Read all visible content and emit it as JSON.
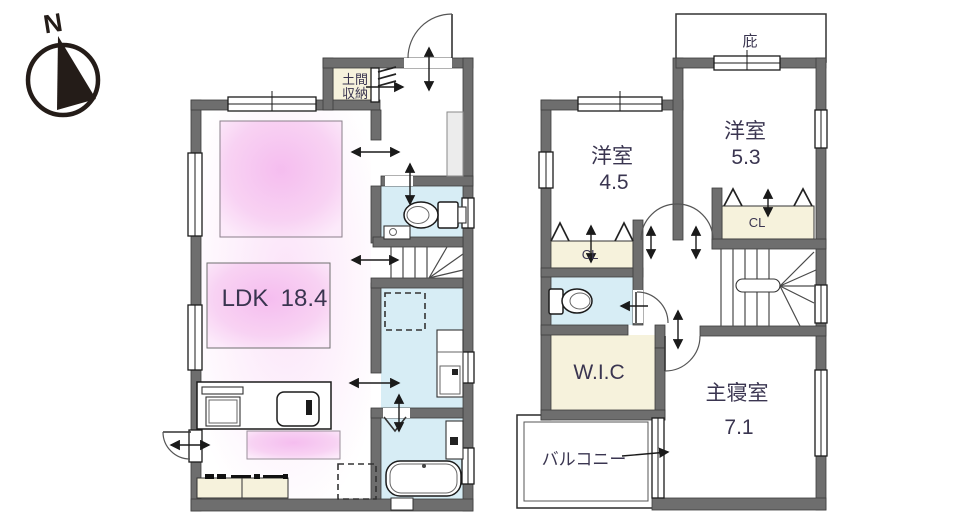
{
  "colors": {
    "wall": "#6e6e6e",
    "water": "#d7edf5",
    "closet": "#f6f2dc",
    "pink": "#f5bdef",
    "text": "#3a3550",
    "line": "#1a1a1a"
  },
  "compass": {
    "north_label": "N"
  },
  "floor1": {
    "ldk": {
      "label": "LDK",
      "area": "18.4"
    },
    "doma": {
      "line1": "土間",
      "line2": "収納"
    }
  },
  "floor2": {
    "room_a": {
      "label": "洋室",
      "area": "4.5"
    },
    "room_b": {
      "label": "洋室",
      "area": "5.3"
    },
    "closet_a": {
      "label": "CL"
    },
    "closet_b": {
      "label": "CL"
    },
    "wic": {
      "label": "W.I.C"
    },
    "master": {
      "label": "主寝室",
      "area": "7.1"
    },
    "balcony": {
      "label": "バルコニー"
    },
    "eaves": {
      "label": "庇"
    }
  }
}
